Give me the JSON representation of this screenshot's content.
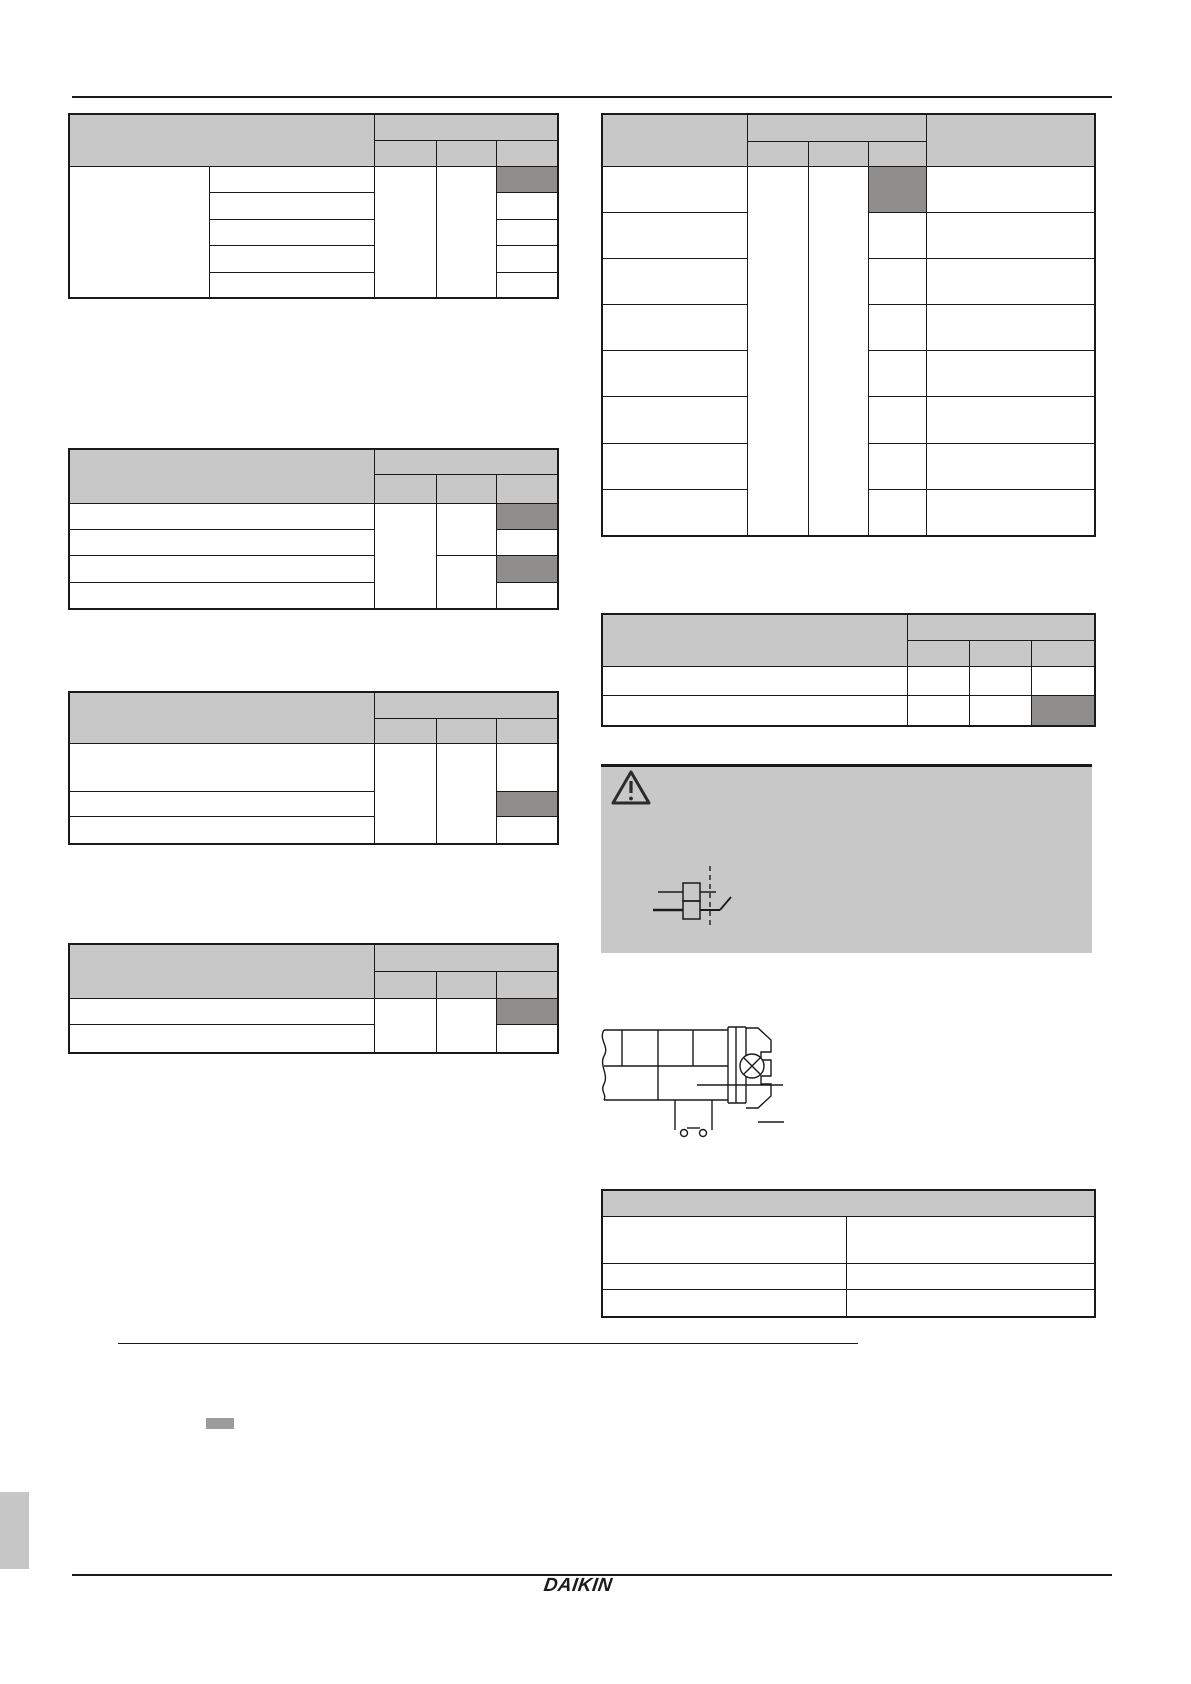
{
  "page": {
    "width": 1191,
    "height": 1684,
    "background": "#ffffff",
    "footer": {
      "logo_text": "DAIKIN"
    }
  },
  "colors": {
    "header_fill": "#c8c8c8",
    "highlight_fill": "#908d8d",
    "warning_fill": "#c8c8c8",
    "border": "#1a1a1a",
    "rule": "#1a1a1a",
    "tab_fill": "#c6c6c6",
    "marker_fill": "#9c9c9c"
  },
  "icons": [
    {
      "name": "warning-triangle-icon",
      "glyph": "outlined triangle with exclamation mark"
    },
    {
      "name": "breaker-switch-icon",
      "glyph": "double-pole breaker with dashed linkage and switch blade"
    },
    {
      "name": "screw-terminal-figure",
      "glyph": "cable cross-section with clamp, screw head (circle with X) and two-pin connector"
    }
  ],
  "rules": {
    "top": {
      "x": 72,
      "y": 96,
      "w": 1040,
      "h": 2
    },
    "section_divider": {
      "x": 118,
      "y": 1343,
      "w": 740,
      "h": 1
    },
    "bottom": {
      "x": 72,
      "y": 1574,
      "w": 1040,
      "h": 2
    }
  },
  "decorations": {
    "page_marker": {
      "x": 206,
      "y": 1418,
      "w": 28,
      "h": 11
    },
    "side_tab": {
      "x": 0,
      "y": 1492,
      "w": 29,
      "h": 77
    }
  },
  "warning_box": {
    "x": 601,
    "y": 764,
    "w": 491,
    "h": 189
  },
  "tables": [
    {
      "name": "spec-table-1",
      "x": 68,
      "y": 113,
      "cols": [
        140,
        165,
        62,
        60,
        60
      ],
      "rows": [
        26,
        26,
        26,
        27,
        26,
        27,
        24
      ],
      "cells": [
        {
          "c": 1,
          "r": 1,
          "cs": 2,
          "rs": 2,
          "t": "hd"
        },
        {
          "c": 3,
          "r": 1,
          "cs": 3,
          "t": "hd"
        },
        {
          "c": 3,
          "r": 2,
          "t": "hd"
        },
        {
          "c": 4,
          "r": 2,
          "t": "hd"
        },
        {
          "c": 5,
          "r": 2,
          "t": "hd"
        },
        {
          "c": 1,
          "r": 3,
          "rs": 5
        },
        {
          "c": 2,
          "r": 3
        },
        {
          "c": 2,
          "r": 4
        },
        {
          "c": 2,
          "r": 5
        },
        {
          "c": 2,
          "r": 6
        },
        {
          "c": 2,
          "r": 7
        },
        {
          "c": 3,
          "r": 3,
          "rs": 5
        },
        {
          "c": 4,
          "r": 3,
          "rs": 5
        },
        {
          "c": 5,
          "r": 3,
          "t": "dk"
        },
        {
          "c": 5,
          "r": 4
        },
        {
          "c": 5,
          "r": 5
        },
        {
          "c": 5,
          "r": 6
        },
        {
          "c": 5,
          "r": 7
        }
      ]
    },
    {
      "name": "spec-table-2",
      "x": 68,
      "y": 448,
      "cols": [
        140,
        165,
        62,
        60,
        60
      ],
      "rows": [
        25,
        29,
        26,
        26,
        27,
        25
      ],
      "cells": [
        {
          "c": 1,
          "r": 1,
          "cs": 2,
          "rs": 2,
          "t": "hd"
        },
        {
          "c": 3,
          "r": 1,
          "cs": 3,
          "t": "hd"
        },
        {
          "c": 3,
          "r": 2,
          "t": "hd"
        },
        {
          "c": 4,
          "r": 2,
          "t": "hd"
        },
        {
          "c": 5,
          "r": 2,
          "t": "hd"
        },
        {
          "c": 1,
          "r": 3,
          "cs": 2
        },
        {
          "c": 1,
          "r": 4,
          "cs": 2
        },
        {
          "c": 1,
          "r": 5,
          "cs": 2
        },
        {
          "c": 1,
          "r": 6,
          "cs": 2
        },
        {
          "c": 3,
          "r": 3,
          "rs": 4
        },
        {
          "c": 4,
          "r": 3,
          "rs": 2
        },
        {
          "c": 4,
          "r": 5,
          "rs": 2
        },
        {
          "c": 5,
          "r": 3,
          "t": "dk"
        },
        {
          "c": 5,
          "r": 4
        },
        {
          "c": 5,
          "r": 5,
          "t": "dk"
        },
        {
          "c": 5,
          "r": 6
        }
      ]
    },
    {
      "name": "spec-table-3",
      "x": 68,
      "y": 691,
      "cols": [
        140,
        165,
        62,
        60,
        60
      ],
      "rows": [
        26,
        25,
        48,
        25,
        26
      ],
      "cells": [
        {
          "c": 1,
          "r": 1,
          "cs": 2,
          "rs": 2,
          "t": "hd"
        },
        {
          "c": 3,
          "r": 1,
          "cs": 3,
          "t": "hd"
        },
        {
          "c": 3,
          "r": 2,
          "t": "hd"
        },
        {
          "c": 4,
          "r": 2,
          "t": "hd"
        },
        {
          "c": 5,
          "r": 2,
          "t": "hd"
        },
        {
          "c": 1,
          "r": 3,
          "cs": 2
        },
        {
          "c": 1,
          "r": 4,
          "cs": 2
        },
        {
          "c": 1,
          "r": 5,
          "cs": 2
        },
        {
          "c": 3,
          "r": 3,
          "rs": 3
        },
        {
          "c": 4,
          "r": 3,
          "rs": 3
        },
        {
          "c": 5,
          "r": 3
        },
        {
          "c": 5,
          "r": 4,
          "t": "dk"
        },
        {
          "c": 5,
          "r": 5
        }
      ]
    },
    {
      "name": "spec-table-4",
      "x": 68,
      "y": 943,
      "cols": [
        140,
        165,
        62,
        60,
        60
      ],
      "rows": [
        27,
        27,
        26,
        27
      ],
      "cells": [
        {
          "c": 1,
          "r": 1,
          "cs": 2,
          "rs": 2,
          "t": "hd"
        },
        {
          "c": 3,
          "r": 1,
          "cs": 3,
          "t": "hd"
        },
        {
          "c": 3,
          "r": 2,
          "t": "hd"
        },
        {
          "c": 4,
          "r": 2,
          "t": "hd"
        },
        {
          "c": 5,
          "r": 2,
          "t": "hd"
        },
        {
          "c": 1,
          "r": 3,
          "cs": 2
        },
        {
          "c": 1,
          "r": 4,
          "cs": 2
        },
        {
          "c": 3,
          "r": 3,
          "rs": 2
        },
        {
          "c": 4,
          "r": 3,
          "rs": 2
        },
        {
          "c": 5,
          "r": 3,
          "t": "dk"
        },
        {
          "c": 5,
          "r": 4
        }
      ]
    },
    {
      "name": "spec-table-5",
      "x": 601,
      "y": 113,
      "cols": [
        145,
        61,
        60,
        58,
        167
      ],
      "rows": [
        27,
        25,
        46,
        46,
        46,
        46,
        46,
        47,
        46,
        45
      ],
      "cells": [
        {
          "c": 1,
          "r": 1,
          "rs": 2,
          "t": "hd"
        },
        {
          "c": 2,
          "r": 1,
          "cs": 3,
          "t": "hd"
        },
        {
          "c": 2,
          "r": 2,
          "t": "hd"
        },
        {
          "c": 3,
          "r": 2,
          "t": "hd"
        },
        {
          "c": 4,
          "r": 2,
          "t": "hd"
        },
        {
          "c": 5,
          "r": 1,
          "rs": 2,
          "t": "hd"
        },
        {
          "c": 1,
          "r": 3
        },
        {
          "c": 1,
          "r": 4
        },
        {
          "c": 1,
          "r": 5
        },
        {
          "c": 1,
          "r": 6
        },
        {
          "c": 1,
          "r": 7
        },
        {
          "c": 1,
          "r": 8
        },
        {
          "c": 1,
          "r": 9
        },
        {
          "c": 1,
          "r": 10
        },
        {
          "c": 2,
          "r": 3,
          "rs": 8
        },
        {
          "c": 3,
          "r": 3,
          "rs": 8
        },
        {
          "c": 4,
          "r": 3,
          "t": "dk"
        },
        {
          "c": 4,
          "r": 4
        },
        {
          "c": 4,
          "r": 5
        },
        {
          "c": 4,
          "r": 6
        },
        {
          "c": 4,
          "r": 7
        },
        {
          "c": 4,
          "r": 8
        },
        {
          "c": 4,
          "r": 9
        },
        {
          "c": 4,
          "r": 10
        },
        {
          "c": 5,
          "r": 3
        },
        {
          "c": 5,
          "r": 4
        },
        {
          "c": 5,
          "r": 5
        },
        {
          "c": 5,
          "r": 6
        },
        {
          "c": 5,
          "r": 7
        },
        {
          "c": 5,
          "r": 8
        },
        {
          "c": 5,
          "r": 9
        },
        {
          "c": 5,
          "r": 10
        }
      ]
    },
    {
      "name": "spec-table-6",
      "x": 601,
      "y": 613,
      "cols": [
        305,
        62,
        62,
        62
      ],
      "rows": [
        26,
        26,
        29,
        29
      ],
      "cells": [
        {
          "c": 1,
          "r": 1,
          "rs": 2,
          "t": "hd"
        },
        {
          "c": 2,
          "r": 1,
          "cs": 3,
          "t": "hd"
        },
        {
          "c": 2,
          "r": 2,
          "t": "hd"
        },
        {
          "c": 3,
          "r": 2,
          "t": "hd"
        },
        {
          "c": 4,
          "r": 2,
          "t": "hd"
        },
        {
          "c": 1,
          "r": 3
        },
        {
          "c": 2,
          "r": 3
        },
        {
          "c": 3,
          "r": 3
        },
        {
          "c": 4,
          "r": 3
        },
        {
          "c": 1,
          "r": 4
        },
        {
          "c": 2,
          "r": 4
        },
        {
          "c": 3,
          "r": 4
        },
        {
          "c": 4,
          "r": 4,
          "t": "dk"
        }
      ]
    },
    {
      "name": "spec-table-7",
      "x": 601,
      "y": 1189,
      "cols": [
        244,
        247
      ],
      "rows": [
        26,
        47,
        26,
        26
      ],
      "cells": [
        {
          "c": 1,
          "r": 1,
          "cs": 2,
          "t": "hd"
        },
        {
          "c": 1,
          "r": 2
        },
        {
          "c": 2,
          "r": 2
        },
        {
          "c": 1,
          "r": 3
        },
        {
          "c": 2,
          "r": 3
        },
        {
          "c": 1,
          "r": 4
        },
        {
          "c": 2,
          "r": 4
        }
      ]
    }
  ]
}
